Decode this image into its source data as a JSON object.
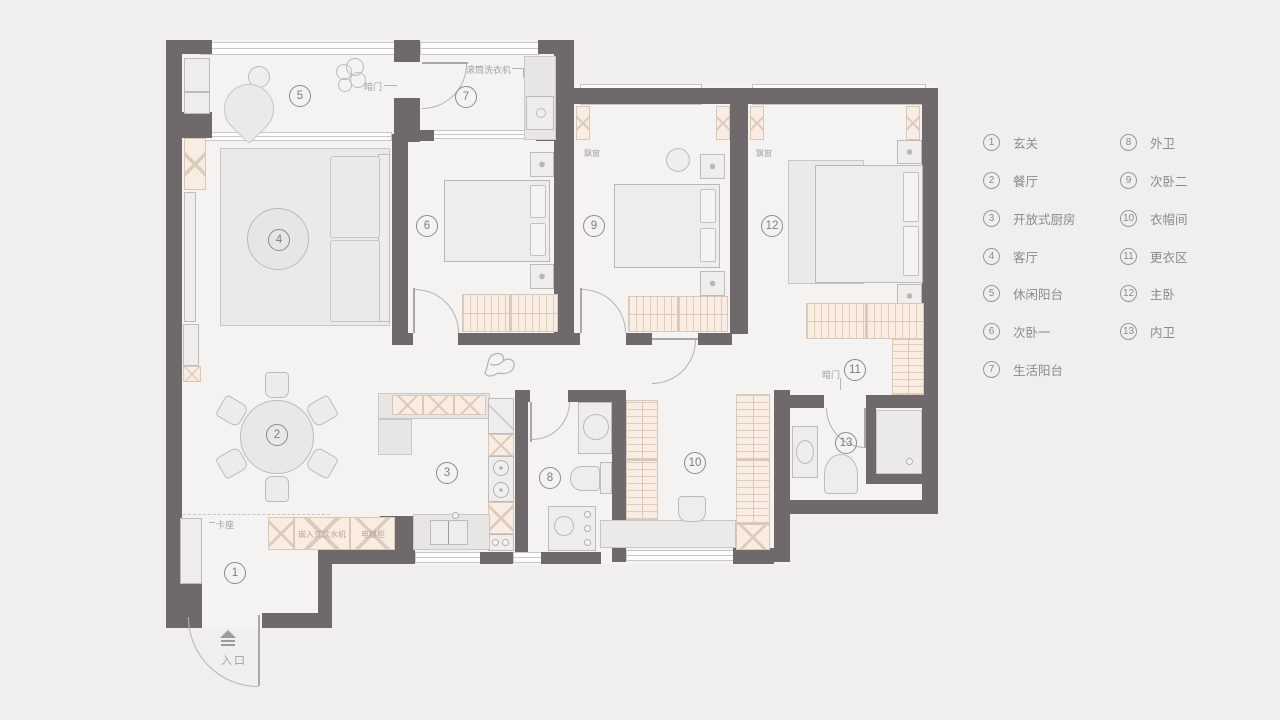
{
  "legend": {
    "items": [
      {
        "num": "1",
        "label": "玄关"
      },
      {
        "num": "2",
        "label": "餐厅"
      },
      {
        "num": "3",
        "label": "开放式厨房"
      },
      {
        "num": "4",
        "label": "客厅"
      },
      {
        "num": "5",
        "label": "休闲阳台"
      },
      {
        "num": "6",
        "label": "次卧一"
      },
      {
        "num": "7",
        "label": "生活阳台"
      },
      {
        "num": "8",
        "label": "外卫"
      },
      {
        "num": "9",
        "label": "次卧二"
      },
      {
        "num": "10",
        "label": "衣帽间"
      },
      {
        "num": "11",
        "label": "更衣区"
      },
      {
        "num": "12",
        "label": "主卧"
      },
      {
        "num": "13",
        "label": "内卫"
      }
    ]
  },
  "plan": {
    "annotations": {
      "entrance": "入口",
      "bench_seat": "卡座",
      "hidden_door_balcony": "暗门",
      "hidden_door_dressing": "暗门",
      "washing_machine": "滚筒洗衣机",
      "bay_window_bed2": "飘窗",
      "bay_window_master": "飘窗",
      "built_in_water_dispenser": "嵌入式饮水机",
      "appliance_cabinet": "电器柜"
    },
    "colors": {
      "wall": "#6f696b",
      "cabinet_fill": "#f9ece2",
      "floor_fill": "#f4f3f2",
      "background": "#f0efee",
      "line": "#bcbbba",
      "text": "#8b8b8d"
    }
  }
}
